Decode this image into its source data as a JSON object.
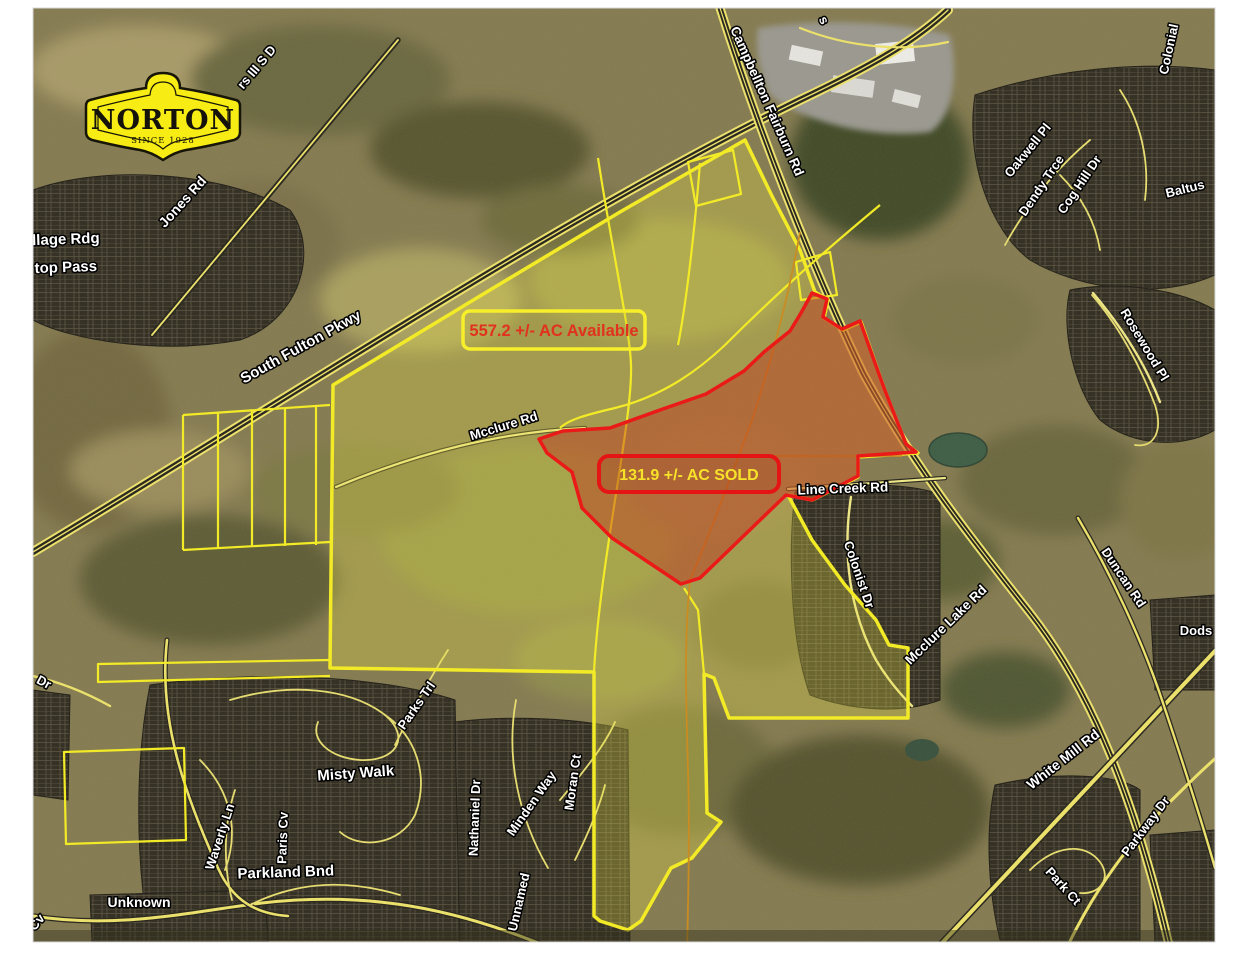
{
  "logo": {
    "name": "NORTON",
    "since": "SINCE 1928"
  },
  "badges": {
    "available": "557.2 +/- AC Available",
    "sold": "131.9 +/- AC SOLD"
  },
  "colors": {
    "parcel_outline_yellow": "#f7ef20",
    "sold_outline_red": "#ee1111",
    "available_text_red": "#e0321e",
    "sold_text_yellow": "#f7e22a",
    "logo_yellow": "#f7ec13"
  },
  "road_labels": [
    {
      "text": "rs III S D",
      "x": 260,
      "y": 70,
      "rot": -50,
      "size": 13
    },
    {
      "text": "s",
      "x": 820,
      "y": 22,
      "rot": 65,
      "size": 13
    },
    {
      "text": "Jones Rd",
      "x": 186,
      "y": 205,
      "rot": -48,
      "size": 14
    },
    {
      "text": "llage Rdg",
      "x": 66,
      "y": 244,
      "rot": -2,
      "size": 15
    },
    {
      "text": "top Pass",
      "x": 66,
      "y": 272,
      "rot": -2,
      "size": 15
    },
    {
      "text": "South Fulton Pkwy",
      "x": 303,
      "y": 351,
      "rot": -29,
      "size": 15
    },
    {
      "text": "Campbellton Fairburn Rd",
      "x": 763,
      "y": 103,
      "rot": 66,
      "size": 13.5
    },
    {
      "text": "Colonial",
      "x": 1173,
      "y": 50,
      "rot": -78,
      "size": 13
    },
    {
      "text": "Oakwell Pl",
      "x": 1031,
      "y": 153,
      "rot": -51,
      "size": 13
    },
    {
      "text": "Dendy Trce",
      "x": 1045,
      "y": 188,
      "rot": -56,
      "size": 13
    },
    {
      "text": "Cog Hill Dr",
      "x": 1083,
      "y": 187,
      "rot": -56,
      "size": 13
    },
    {
      "text": "Baltus",
      "x": 1186,
      "y": 193,
      "rot": -14,
      "size": 13
    },
    {
      "text": "Rosewood Pl",
      "x": 1141,
      "y": 347,
      "rot": 59,
      "size": 13
    },
    {
      "text": "Duncan Rd",
      "x": 1120,
      "y": 580,
      "rot": 56,
      "size": 13
    },
    {
      "text": "Line Creek Rd",
      "x": 843,
      "y": 493,
      "rot": -2,
      "size": 13.5
    },
    {
      "text": "Colonist Dr",
      "x": 855,
      "y": 576,
      "rot": 71,
      "size": 13
    },
    {
      "text": "Mcclure Lake Rd",
      "x": 949,
      "y": 628,
      "rot": -44,
      "size": 13.5
    },
    {
      "text": "Mcclure Rd",
      "x": 505,
      "y": 430,
      "rot": -17,
      "size": 13
    },
    {
      "text": "Misty Walk",
      "x": 356,
      "y": 778,
      "rot": -4,
      "size": 15
    },
    {
      "text": "Parks Trl",
      "x": 420,
      "y": 708,
      "rot": -55,
      "size": 13
    },
    {
      "text": "Waverly Ln",
      "x": 224,
      "y": 838,
      "rot": -72,
      "size": 13
    },
    {
      "text": "Paris Cv",
      "x": 287,
      "y": 838,
      "rot": -88,
      "size": 13
    },
    {
      "text": "Parkland Bnd",
      "x": 286,
      "y": 877,
      "rot": -2,
      "size": 15
    },
    {
      "text": "Unknown",
      "x": 139,
      "y": 907,
      "rot": 0,
      "size": 14
    },
    {
      "text": "Cv",
      "x": 40,
      "y": 925,
      "rot": -50,
      "size": 13
    },
    {
      "text": "Dr",
      "x": 42,
      "y": 686,
      "rot": 28,
      "size": 13
    },
    {
      "text": "Nathaniel Dr",
      "x": 479,
      "y": 818,
      "rot": -88,
      "size": 13
    },
    {
      "text": "Minden Way",
      "x": 535,
      "y": 806,
      "rot": -55,
      "size": 13
    },
    {
      "text": "Moran Ct",
      "x": 577,
      "y": 783,
      "rot": -82,
      "size": 13
    },
    {
      "text": "Unnamed",
      "x": 523,
      "y": 903,
      "rot": -77,
      "size": 13
    },
    {
      "text": "White Mill Rd",
      "x": 1066,
      "y": 763,
      "rot": -38,
      "size": 14
    },
    {
      "text": "Parkway Dr",
      "x": 1149,
      "y": 829,
      "rot": -53,
      "size": 13
    },
    {
      "text": "Park Ct",
      "x": 1060,
      "y": 889,
      "rot": 48,
      "size": 13
    },
    {
      "text": "Dods",
      "x": 1196,
      "y": 635,
      "rot": 0,
      "size": 13
    }
  ]
}
